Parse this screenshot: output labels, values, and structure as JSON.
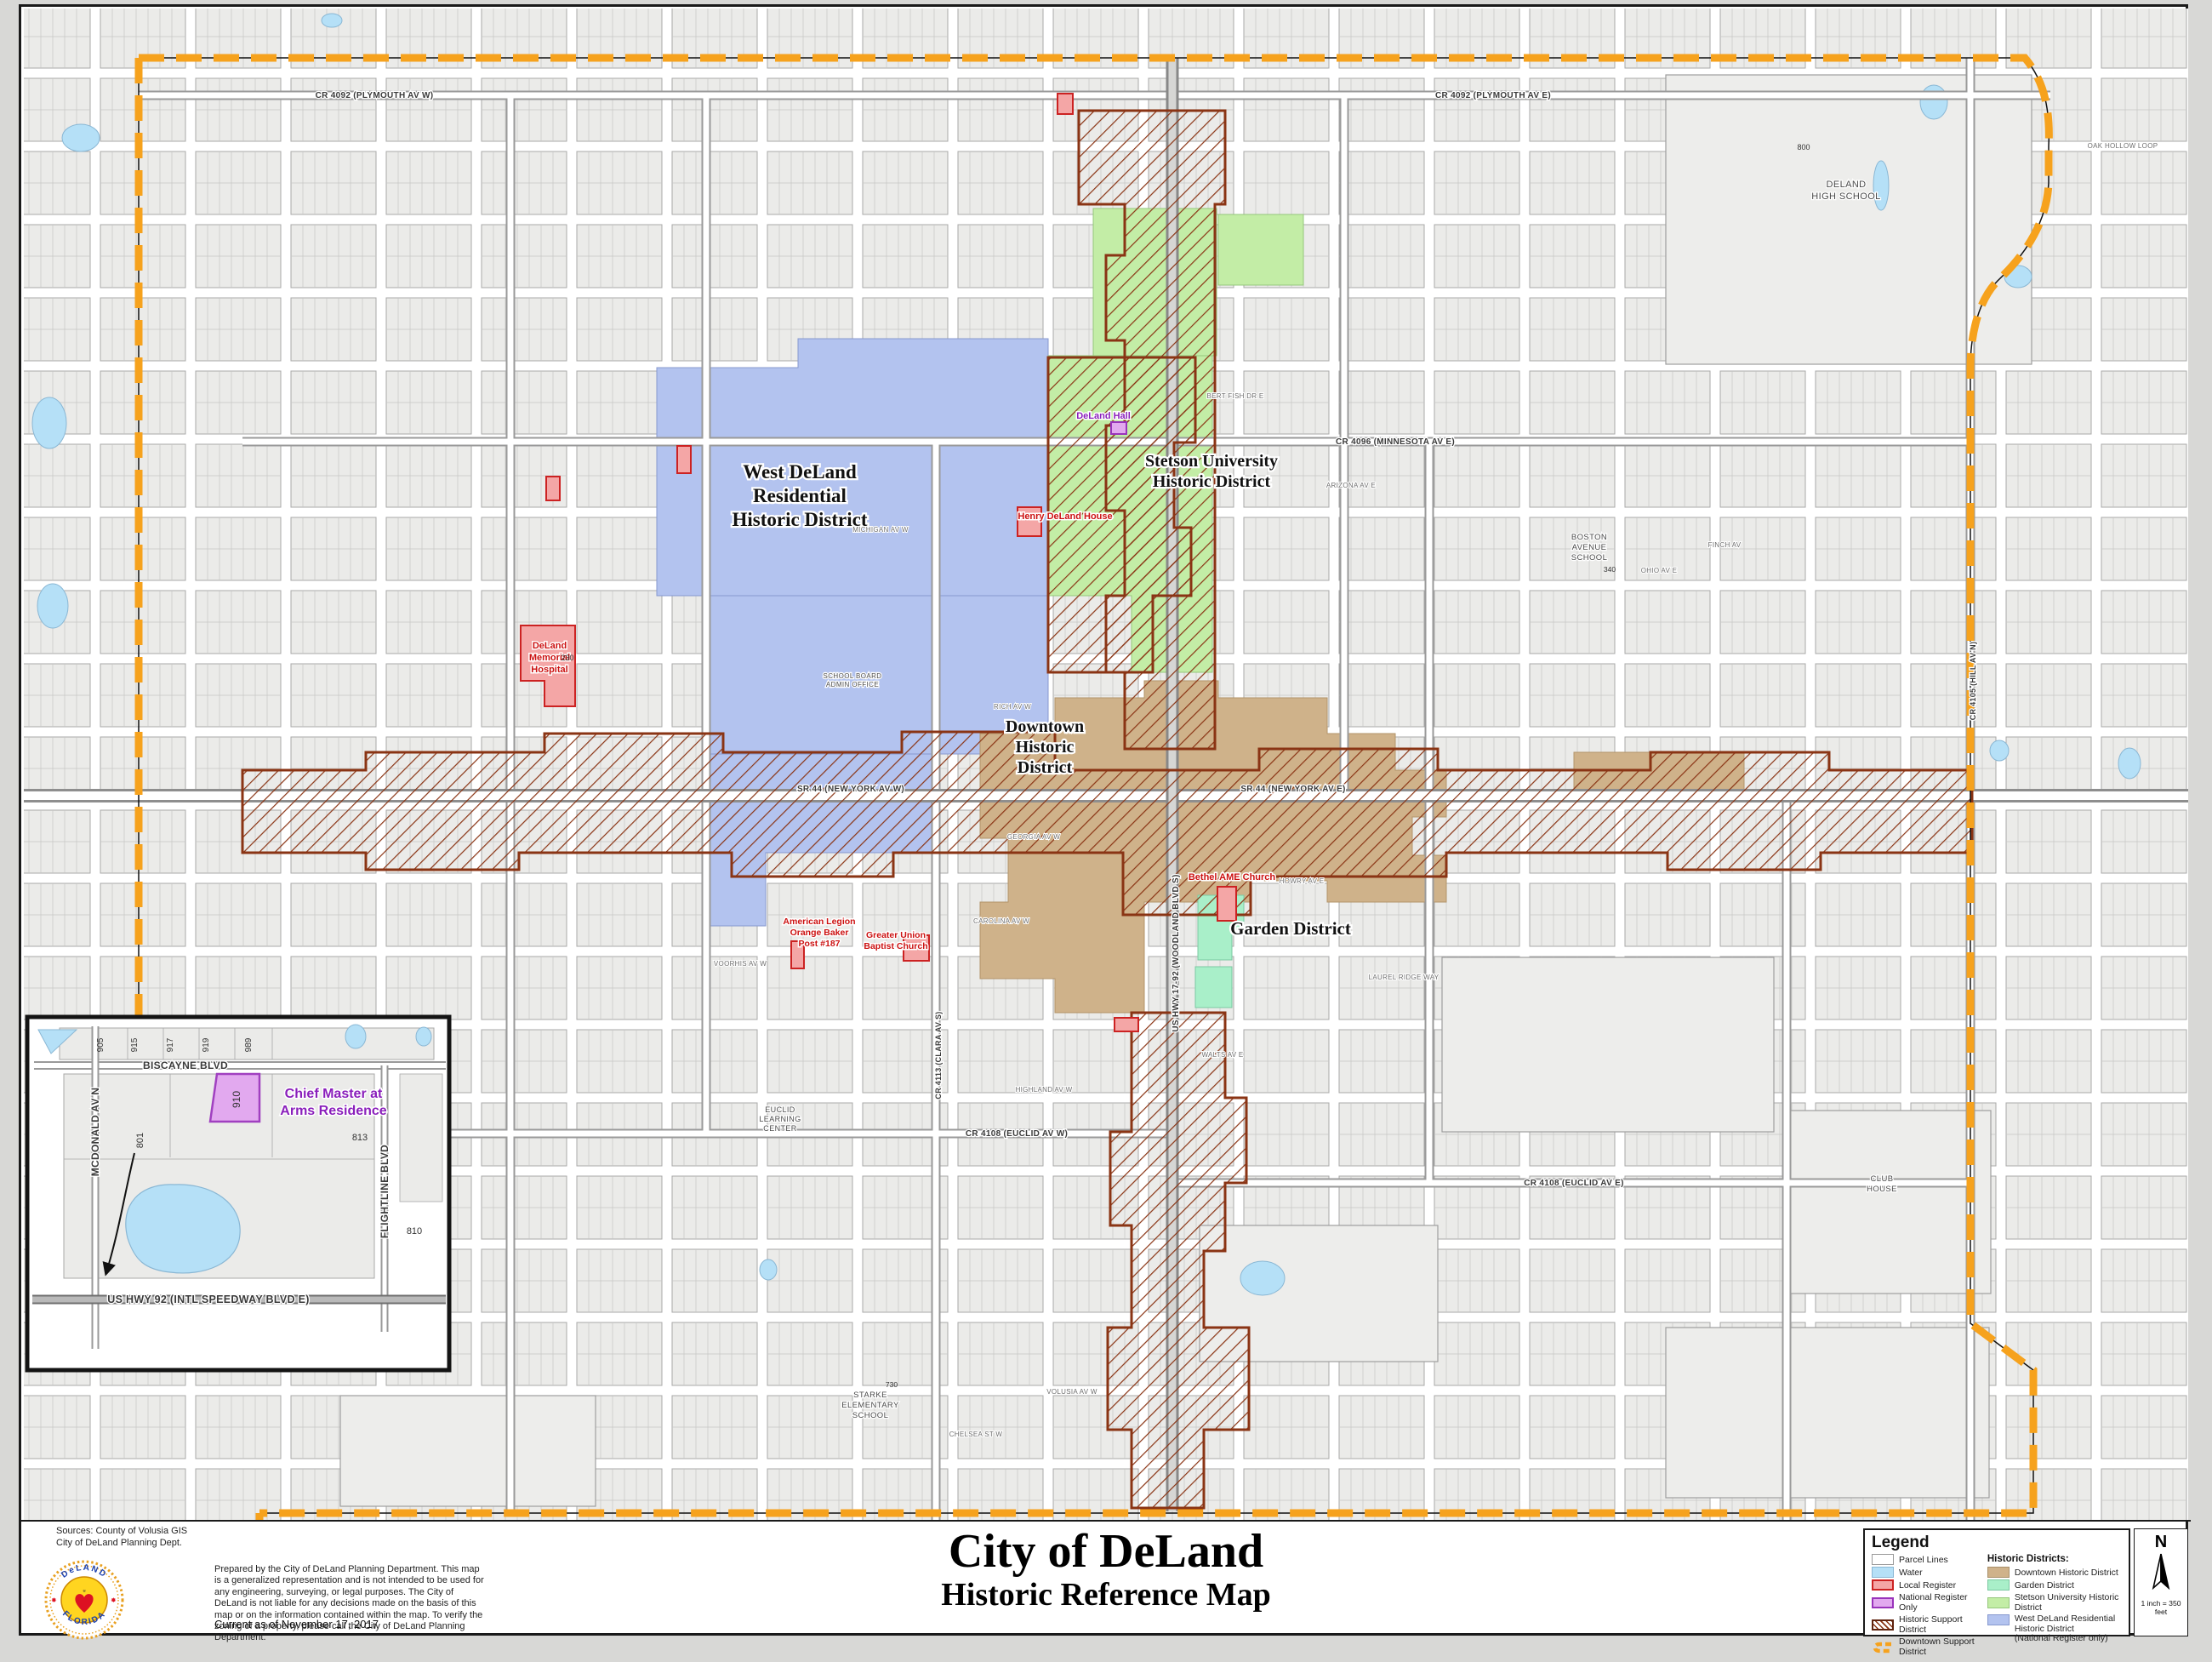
{
  "colors": {
    "water": "#b5e0f7",
    "boundary_orange": "#f6a21d",
    "hatch_brown": "#8a3414",
    "west_deland": "#b3c3ef",
    "stetson": "#c3eda6",
    "garden": "#a9efc9",
    "downtown": "#cfb28a",
    "local_register": "#f4a6a6",
    "national_register": "#e2a9ef"
  },
  "title_block": {
    "title": "City of DeLand",
    "subtitle": "Historic Reference Map"
  },
  "sources": {
    "line1": "Sources: County of Volusia GIS",
    "line2": "City of DeLand Planning Dept."
  },
  "notes": {
    "disclaimer": "Prepared by the City of DeLand Planning Department. This map is a generalized representation and is not intended to be used for any engineering, surveying, or legal purposes.  The City of DeLand is not liable for any decisions made on the basis of this map or on the information contained within the map.  To verify the zoning of a property, please call the City of DeLand Planning Department.",
    "current_as_of": "Current as of November 17, 2017"
  },
  "logo": {
    "arc_top": "DeLAND",
    "arc_bottom": "FLORIDA"
  },
  "legend": {
    "title": "Legend",
    "items_left": [
      {
        "label": "Parcel Lines"
      },
      {
        "label": "Water"
      },
      {
        "label": "Local Register"
      },
      {
        "label": "National Register Only"
      },
      {
        "label": "Historic Support District"
      },
      {
        "label": "Downtown Support District"
      }
    ],
    "districts_header": "Historic Districts:",
    "items_right": [
      {
        "label": "Downtown Historic District"
      },
      {
        "label": "Garden District"
      },
      {
        "label": "Stetson University Historic District"
      },
      {
        "label": "West DeLand Residential Historic District",
        "label2": "(National Register only)"
      }
    ]
  },
  "compass": {
    "north": "N",
    "scale": "1 inch = 350 feet"
  },
  "map": {
    "district_labels": {
      "west_deland": {
        "line1": "West DeLand",
        "line2": "Residential",
        "line3": "Historic District"
      },
      "stetson": {
        "line1": "Stetson University",
        "line2": "Historic District"
      },
      "downtown": {
        "line1": "Downtown",
        "line2": "Historic",
        "line3": "District"
      },
      "garden": {
        "line1": "Garden District"
      }
    },
    "red_landmarks": {
      "hospital": {
        "line1": "DeLand",
        "line2": "Memorial",
        "line3": "Hospital",
        "num": "230"
      },
      "henry": {
        "line1": "Henry DeLand House"
      },
      "bethel": {
        "line1": "Bethel AME Church"
      },
      "legion": {
        "line1": "American Legion",
        "line2": "Orange Baker",
        "line3": "Post #187"
      },
      "union": {
        "line1": "Greater Union",
        "line2": "Baptist Church"
      }
    },
    "purple_landmarks": {
      "deland_hall": {
        "line1": "DeLand Hall"
      }
    },
    "places": {
      "high_school": {
        "line1": "DELAND",
        "line2": "HIGH SCHOOL",
        "num": "800"
      },
      "boston": {
        "line1": "BOSTON",
        "line2": "AVENUE",
        "line3": "SCHOOL",
        "num": "340"
      },
      "school_board": {
        "line1": "SCHOOL BOARD",
        "line2": "ADMIN OFFICE"
      },
      "euclid_center": {
        "line1": "EUCLID",
        "line2": "LEARNING",
        "line3": "CENTER"
      },
      "starke": {
        "line1": "STARKE",
        "line2": "ELEMENTARY",
        "line3": "SCHOOL",
        "num": "730"
      },
      "club": {
        "line1": "CLUB",
        "line2": "HOUSE"
      }
    },
    "roads": {
      "plymouth_w": "CR 4092 (PLYMOUTH AV W)",
      "plymouth_e": "CR 4092 (PLYMOUTH AV E)",
      "minnesota": "CR 4096 (MINNESOTA AV E)",
      "newyork_w": "SR 44 (NEW YORK AV W)",
      "newyork_e": "SR 44 (NEW YORK AV E)",
      "euclid_w": "CR 4108 (EUCLID AV W)",
      "euclid_e": "CR 4108 (EUCLID AV E)",
      "beresford": "CR 4101 (BERESFORD AV E)",
      "woodland": "US HWY 17-92 (WOODLAND BLVD S)",
      "clara": "CR 4113 (CLARA AV S)",
      "hill": "CR 4105 (HILL AV N)",
      "voorhis": "VOORHIS AV W",
      "howry": "HOWRY AV E",
      "michigan": "MICHIGAN AV W",
      "bertfish": "BERT FISH DR E",
      "arizona": "ARIZONA AV E",
      "rich": "RICH AV W",
      "georgia": "GEORGIA AV W",
      "carolina": "CAROLINA AV W",
      "volusia": "VOLUSIA AV W",
      "chelsea": "CHELSEA ST W",
      "ohio": "OHIO AV E",
      "finch": "FINCH AV",
      "oakhollow": "OAK HOLLOW LOOP",
      "laurel": "LAUREL RIDGE WAY",
      "walts": "WALTS AV E",
      "highland": "HIGHLAND AV W"
    }
  },
  "inset": {
    "roads": {
      "biscayne": "BISCAYNE BLVD",
      "mcdonald": "MCDONALD AV N",
      "flightline": "FLIGHTLINE BLVD",
      "speedway": "US HWY 92 (INTL SPEEDWAY BLVD E)"
    },
    "landmark": {
      "line1": "Chief Master at",
      "line2": "Arms Residence",
      "num": "910"
    },
    "numbers": {
      "n905": "905",
      "n915": "915",
      "n917": "917",
      "n919": "919",
      "n989": "989",
      "n801": "801",
      "n813": "813",
      "n810": "810"
    }
  }
}
